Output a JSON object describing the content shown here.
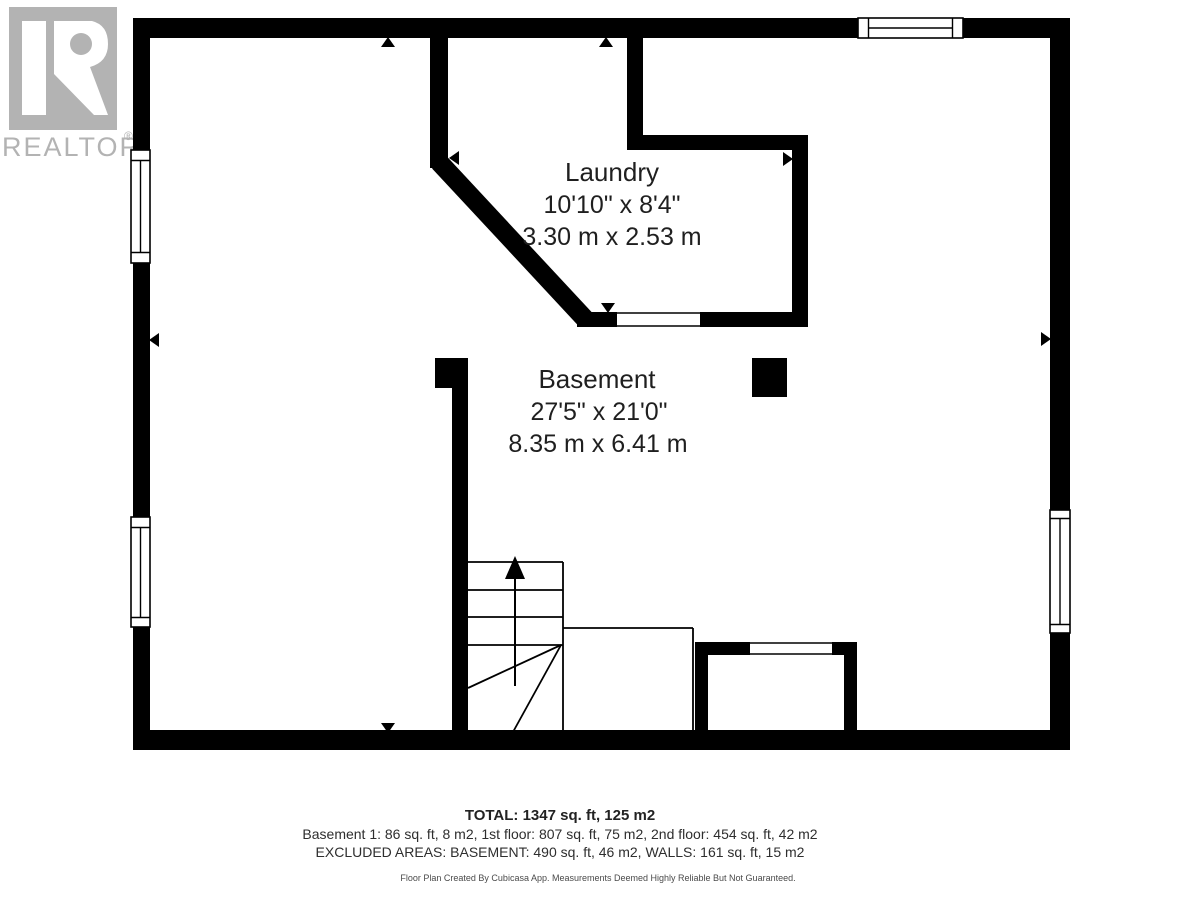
{
  "branding": {
    "logo_text": "REALTOR",
    "registered_mark": "®",
    "logo_gray": "#b3b3b3"
  },
  "rooms": [
    {
      "name": "Laundry",
      "imperial": "10'10\" x 8'4\"",
      "metric": "3.30 m x 2.53 m"
    },
    {
      "name": "Basement",
      "imperial": "27'5\" x 21'0\"",
      "metric": "8.35 m x 6.41 m"
    }
  ],
  "summary": {
    "total": "TOTAL: 1347 sq. ft, 125 m2",
    "breakdown": "Basement 1: 86 sq. ft, 8 m2, 1st floor: 807 sq. ft, 75 m2, 2nd floor: 454 sq. ft, 42 m2",
    "excluded": "EXCLUDED AREAS: BASEMENT: 490 sq. ft, 46 m2, WALLS: 161 sq. ft, 15 m2"
  },
  "disclaimer": "Floor Plan Created By Cubicasa App. Measurements Deemed Highly Reliable But Not Guaranteed.",
  "colors": {
    "wall": "#000000",
    "background": "#ffffff",
    "text": "#1f1f1f"
  }
}
